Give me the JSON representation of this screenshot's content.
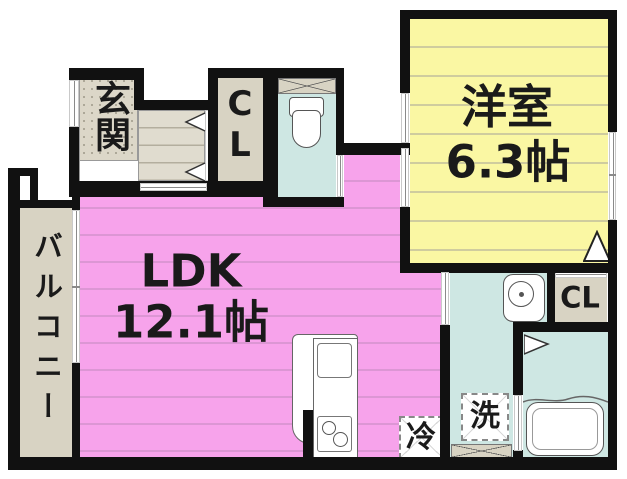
{
  "plan_title": "1LDK floor plan",
  "colors": {
    "wall": "#111111",
    "ldk_pink": "#F7A3EB",
    "room_yellow": "#FAF7A3",
    "wet_teal": "#CEE7E3",
    "balcony_beige": "#D8D3C3"
  },
  "rooms": {
    "entrance": {
      "label": "玄関"
    },
    "closet_upper": {
      "line1": "C",
      "line2": "L"
    },
    "western_room": {
      "name": "洋室",
      "size": "6.3帖"
    },
    "ldk": {
      "name": "LDK",
      "size": "12.1帖"
    },
    "balcony": {
      "label": "バルコニー"
    },
    "closet_lower": {
      "label": "CL"
    }
  },
  "appliances": {
    "fridge": "冷",
    "washer": "洗"
  }
}
